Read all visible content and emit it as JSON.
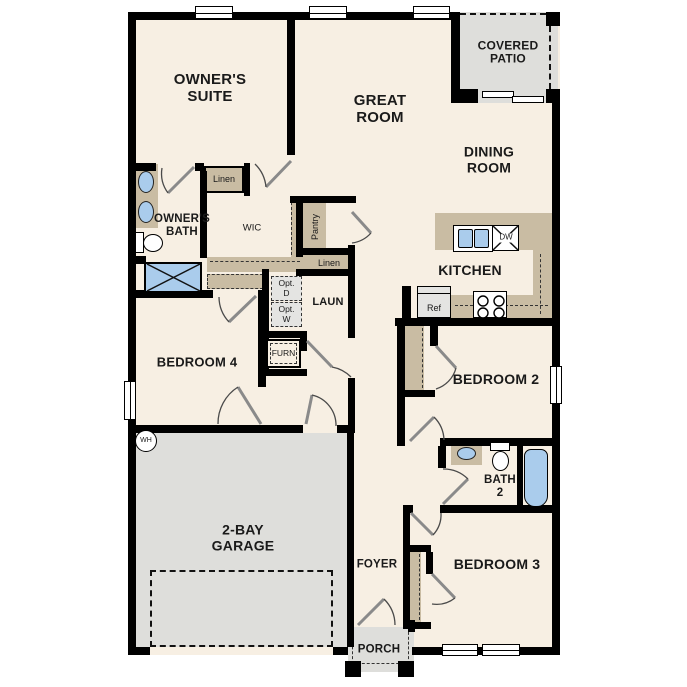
{
  "palette": {
    "bg": "#FFFFFF",
    "floor": "#F7EFE3",
    "wall": "#000000",
    "cabinet": "#C9BCA3",
    "concrete": "#DEDEDB",
    "fixture": "#AACCEC",
    "appliance": "#E4E4E2",
    "ink": "#1A1A1A"
  },
  "rooms": {
    "owners_suite": "OWNER'S\nSUITE",
    "great_room": "GREAT\nROOM",
    "covered_patio": "COVERED\nPATIO",
    "dining_room": "DINING\nROOM",
    "owners_bath": "OWNER'S\nBATH",
    "wic": "WIC",
    "kitchen": "KITCHEN",
    "laundry": "LAUN",
    "bedroom4": "BEDROOM 4",
    "bedroom2": "BEDROOM 2",
    "bath2": "BATH\n2",
    "garage": "2-BAY\nGARAGE",
    "foyer": "FOYER",
    "bedroom3": "BEDROOM 3",
    "porch": "PORCH"
  },
  "closets": {
    "linen_upper": "Linen",
    "linen_lower": "Linen",
    "pantry": "Pantry"
  },
  "fixtures": {
    "water_heater": "WH",
    "furnace": "FURN",
    "dishwasher": "DW",
    "refrigerator": "Ref",
    "opt_dryer": "Opt.\nD",
    "opt_washer": "Opt.\nW"
  }
}
